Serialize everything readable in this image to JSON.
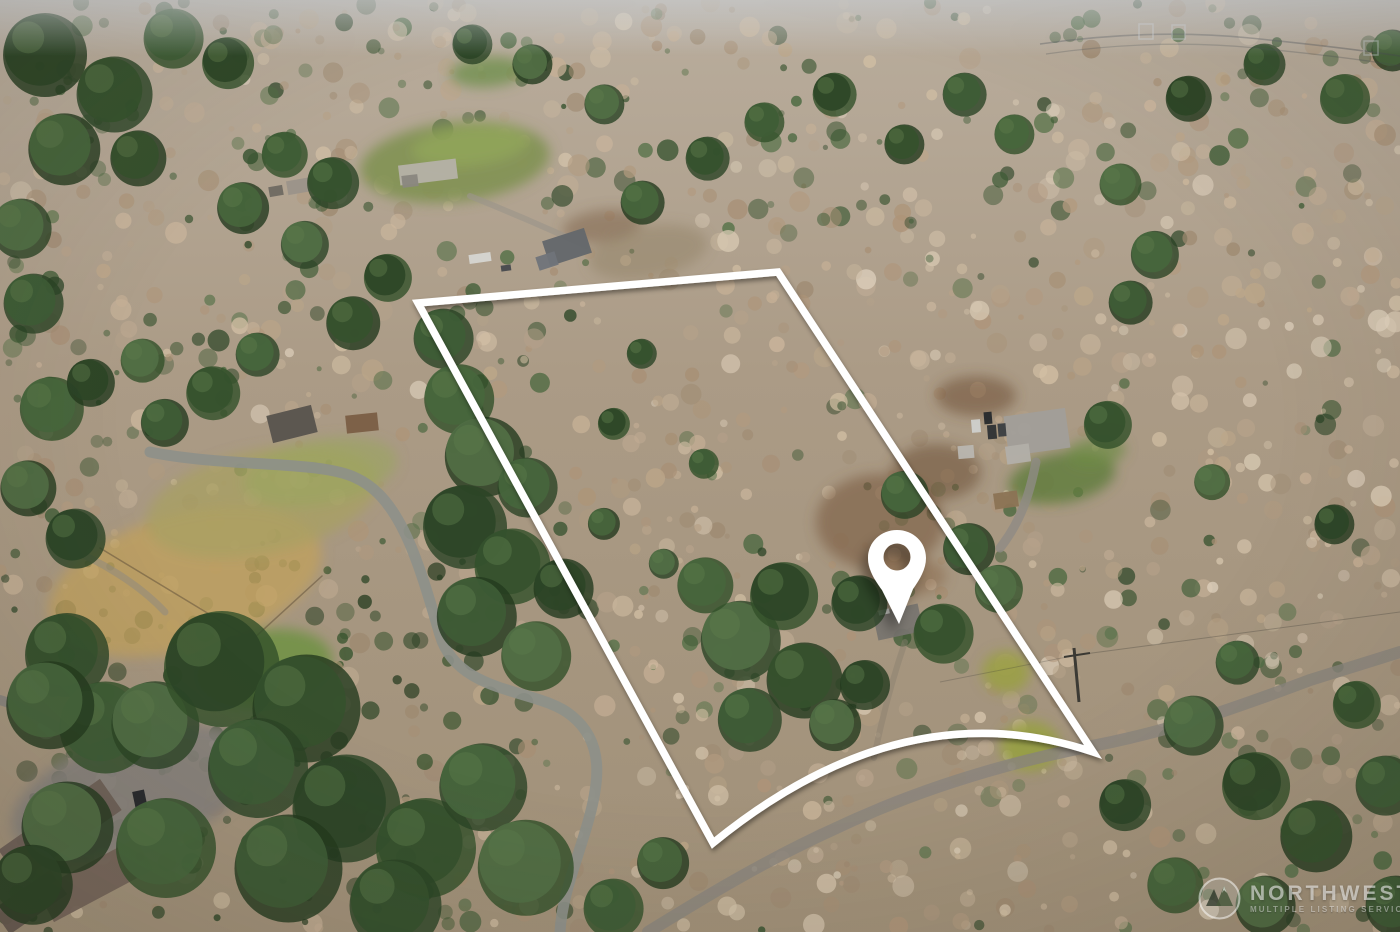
{
  "watermark": {
    "brand": "NORTHWEST",
    "tagline": "MULTIPLE LISTING SERVICE",
    "logo": "mountain-peaks-icon"
  },
  "overlays": {
    "boundary_color": "#ffffff",
    "pin_color": "#ffffff"
  },
  "scene": {
    "type": "aerial-drone-photograph",
    "subject": "wooded winter acreage with white property-line outline, location pin over home, winding road, neighboring houses"
  },
  "colors": {
    "forest_tan": "#b3a089",
    "forest_green": "#3e5c36",
    "road_gray": "#8d9089",
    "haze": "#ccd1d6"
  }
}
